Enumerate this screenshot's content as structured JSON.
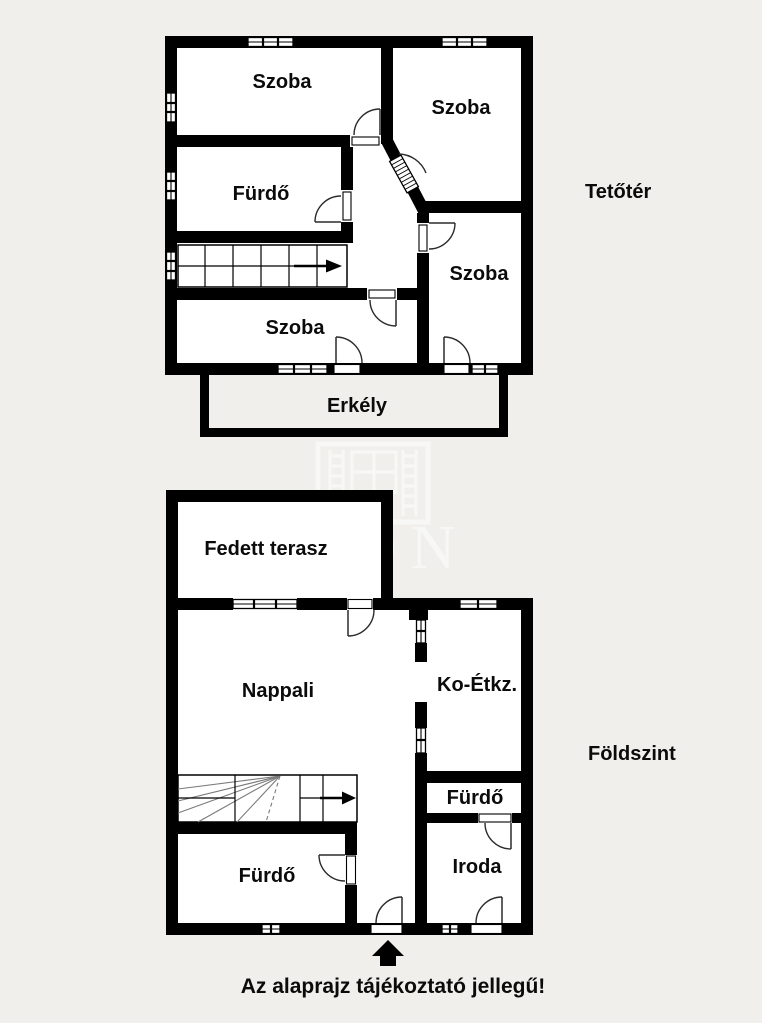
{
  "page": {
    "disclaimer": "Az alaprajz tájékoztató jellegű!",
    "colors": {
      "background": "#f0efeb",
      "wall": "#000000",
      "room_fill": "#ffffff"
    }
  },
  "floors": {
    "attic": {
      "label": "Tetőtér",
      "rooms": {
        "room_top_left": {
          "label": "Szoba"
        },
        "room_top_right": {
          "label": "Szoba"
        },
        "bathroom": {
          "label": "Fürdő"
        },
        "room_bottom_left": {
          "label": "Szoba"
        },
        "room_bottom_right": {
          "label": "Szoba"
        },
        "balcony": {
          "label": "Erkély"
        }
      }
    },
    "ground": {
      "label": "Földszint",
      "rooms": {
        "covered_terrace": {
          "label": "Fedett terasz"
        },
        "living_room": {
          "label": "Nappali"
        },
        "kitchen_dining": {
          "label": "Ko-Étkz."
        },
        "bathroom_upper": {
          "label": "Fürdő"
        },
        "office": {
          "label": "Iroda"
        },
        "bathroom_lower": {
          "label": "Fürdő"
        }
      }
    }
  },
  "watermark": {
    "letters": "ON"
  }
}
